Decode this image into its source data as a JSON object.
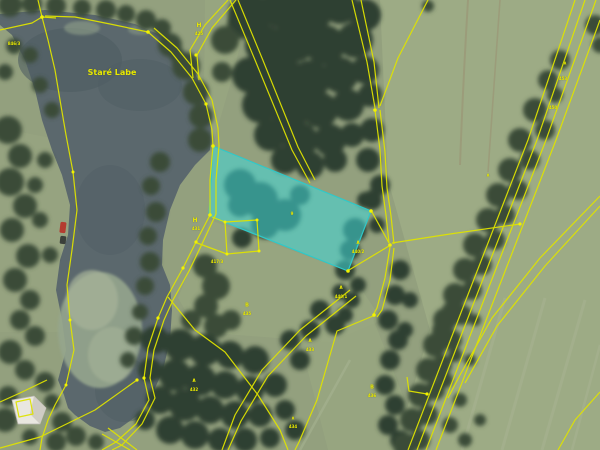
{
  "map": {
    "type": "orthophoto-cadastre-view",
    "water_body_name": "Staré Labe",
    "highlight": {
      "description": "selected parcel highlighted cyan"
    },
    "colors": {
      "grass": "#93a07e",
      "field_light": "#9dab85",
      "grass_mid": "#99a681",
      "water": "#5b686d",
      "water_deep": "#4f5d63",
      "lily": "#95a58d",
      "lily_light": "#a6b498",
      "tree_dark": "#2f3f30",
      "tree_mid": "#3b4c39",
      "tree_light": "#49573f",
      "parcel_line": "#dfe300",
      "node_dot": "#f2f200",
      "label_yellow": "#e8e800",
      "highlight_fill": "#3fd9d9",
      "highlight_edge": "#2fc9c9",
      "track_brown": "#9b9072",
      "track_light": "#a8b492",
      "building_white": "#e9e7e0",
      "car_red": "#b43c30"
    },
    "labels": [
      {
        "name": "water-name-label",
        "text": "Staré Labe",
        "x": 112,
        "y": 73,
        "size": 8
      },
      {
        "name": "landuse-symbol",
        "text": "H",
        "x": 199,
        "y": 26,
        "size": 6
      },
      {
        "name": "parcel-number",
        "text": "425",
        "x": 199,
        "y": 34,
        "size": 4
      },
      {
        "name": "parcel-number",
        "text": "846/3",
        "x": 14,
        "y": 44,
        "size": 4
      },
      {
        "name": "landuse-symbol",
        "text": "H",
        "x": 195,
        "y": 221,
        "size": 6
      },
      {
        "name": "parcel-number",
        "text": "431",
        "x": 196,
        "y": 229,
        "size": 4
      },
      {
        "name": "parcel-number",
        "text": "417/3",
        "x": 217,
        "y": 262,
        "size": 4
      },
      {
        "name": "landuse-symbol",
        "text": "B",
        "x": 247,
        "y": 306,
        "size": 5
      },
      {
        "name": "parcel-number",
        "text": "435",
        "x": 247,
        "y": 314,
        "size": 4
      },
      {
        "name": "parcel-number",
        "text": "9",
        "x": 292,
        "y": 214,
        "size": 4
      },
      {
        "name": "conifer-symbol",
        "text": "∧",
        "x": 358,
        "y": 243,
        "size": 6
      },
      {
        "name": "parcel-number",
        "text": "440/2",
        "x": 358,
        "y": 252,
        "size": 4
      },
      {
        "name": "conifer-symbol",
        "text": "∧",
        "x": 341,
        "y": 288,
        "size": 6
      },
      {
        "name": "parcel-number",
        "text": "440/1",
        "x": 341,
        "y": 297,
        "size": 4
      },
      {
        "name": "conifer-symbol",
        "text": "∧",
        "x": 310,
        "y": 341,
        "size": 6
      },
      {
        "name": "parcel-number",
        "text": "433",
        "x": 310,
        "y": 350,
        "size": 4
      },
      {
        "name": "conifer-symbol",
        "text": "∧",
        "x": 194,
        "y": 381,
        "size": 6
      },
      {
        "name": "parcel-number",
        "text": "432",
        "x": 194,
        "y": 390,
        "size": 4
      },
      {
        "name": "conifer-symbol",
        "text": "∧",
        "x": 293,
        "y": 419,
        "size": 5
      },
      {
        "name": "parcel-number",
        "text": "434",
        "x": 293,
        "y": 427,
        "size": 4
      },
      {
        "name": "landuse-symbol",
        "text": "B",
        "x": 372,
        "y": 388,
        "size": 5
      },
      {
        "name": "parcel-number",
        "text": "436",
        "x": 372,
        "y": 396,
        "size": 4
      },
      {
        "name": "conifer-symbol",
        "text": "∧",
        "x": 565,
        "y": 64,
        "size": 5
      },
      {
        "name": "parcel-number",
        "text": "453",
        "x": 563,
        "y": 79,
        "size": 4
      },
      {
        "name": "parcel-number",
        "text": "450",
        "x": 553,
        "y": 108,
        "size": 4
      },
      {
        "name": "conifer-symbol",
        "text": "∧",
        "x": 488,
        "y": 176,
        "size": 5
      }
    ]
  }
}
